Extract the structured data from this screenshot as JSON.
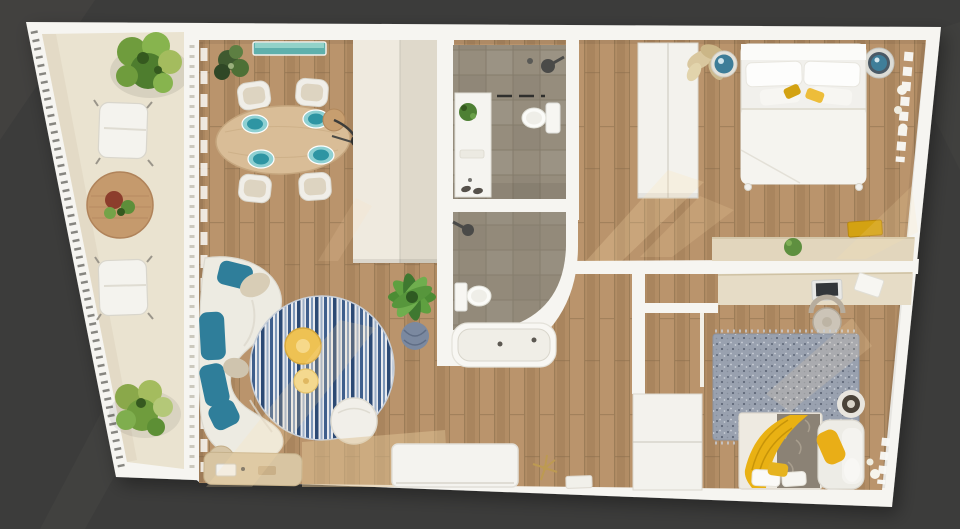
{
  "scene": {
    "type": "3d-floor-plan-top-view",
    "rooms": [
      "balcony",
      "living-dining-room",
      "kitchen",
      "bathroom-1",
      "bathroom-2",
      "hallway",
      "bedroom-1",
      "bedroom-2"
    ],
    "furniture": [
      "lounge-chairs",
      "terrace-table",
      "trees",
      "dining-table",
      "dining-chairs",
      "teal-sideboard",
      "floor-lamp",
      "curved-sofa",
      "round-striped-rug",
      "coffee-tables",
      "pouf",
      "potted-palm",
      "kitchen-counter",
      "kitchen-island",
      "vanity",
      "toilet",
      "shower",
      "bathtub",
      "hall-closet",
      "double-bed",
      "nightstands",
      "desk",
      "office-chair",
      "single-bed",
      "armchair",
      "area-rug",
      "wardrobe"
    ]
  },
  "colors": {
    "bg": "#3c3c3b",
    "bg_streak": "#474644",
    "wall": "#f6f5f1",
    "wall_shade": "#e6e4dd",
    "balcony": "#eae3d0",
    "balcony_shade": "#dcd3bd",
    "wood": "#b28d65",
    "wood_light": "#c09a72",
    "wood_dark": "#9d7d57",
    "wood_line": "#8a6e4c",
    "tile": "#968d7d",
    "tile_line": "#847b6b",
    "tile2": "#8d8475",
    "cabinet_light": "#efeadf",
    "cabinet_dark": "#dfd9cb",
    "closet": "#f3f2ed",
    "seam": "#c9c5ba",
    "teal": "#2f7e9a",
    "teal_light": "#8ed0d2",
    "teal_deep": "#2e95a3",
    "sideboard_teal": "#5fb0ac",
    "sideboard_teal_light": "#92d2c9",
    "sofa": "#edebe2",
    "cushion_beige": "#d8cdb6",
    "rug_navy": "#2c4a74",
    "rug_blue": "#3f5f8c",
    "rug_mid": "#7d97b8",
    "rug_pale": "#e8eaee",
    "rug2": "#99a1af",
    "rug2_dark": "#5f6878",
    "rug2_light": "#c9ced8",
    "duvet": "#8b8275",
    "yellow": "#e9b113",
    "amber": "#d3a212",
    "yellow_pale": "#f2d888",
    "gold": "#bd9a52",
    "desk": "#e2d6bd",
    "counter": "#d8c5a2",
    "table_wood": "#d9bd97",
    "terrace_table": "#c59a6d",
    "green_dark": "#4e7d2e",
    "green": "#6f9c3d",
    "green_light": "#87b44e",
    "olive": "#a4bc5e",
    "leaf_dark": "#35591f",
    "plant_red": "#8c3d2c",
    "fixture": "#4a4a46",
    "white": "#fbfbf8",
    "sun": "#ffe3b0"
  }
}
